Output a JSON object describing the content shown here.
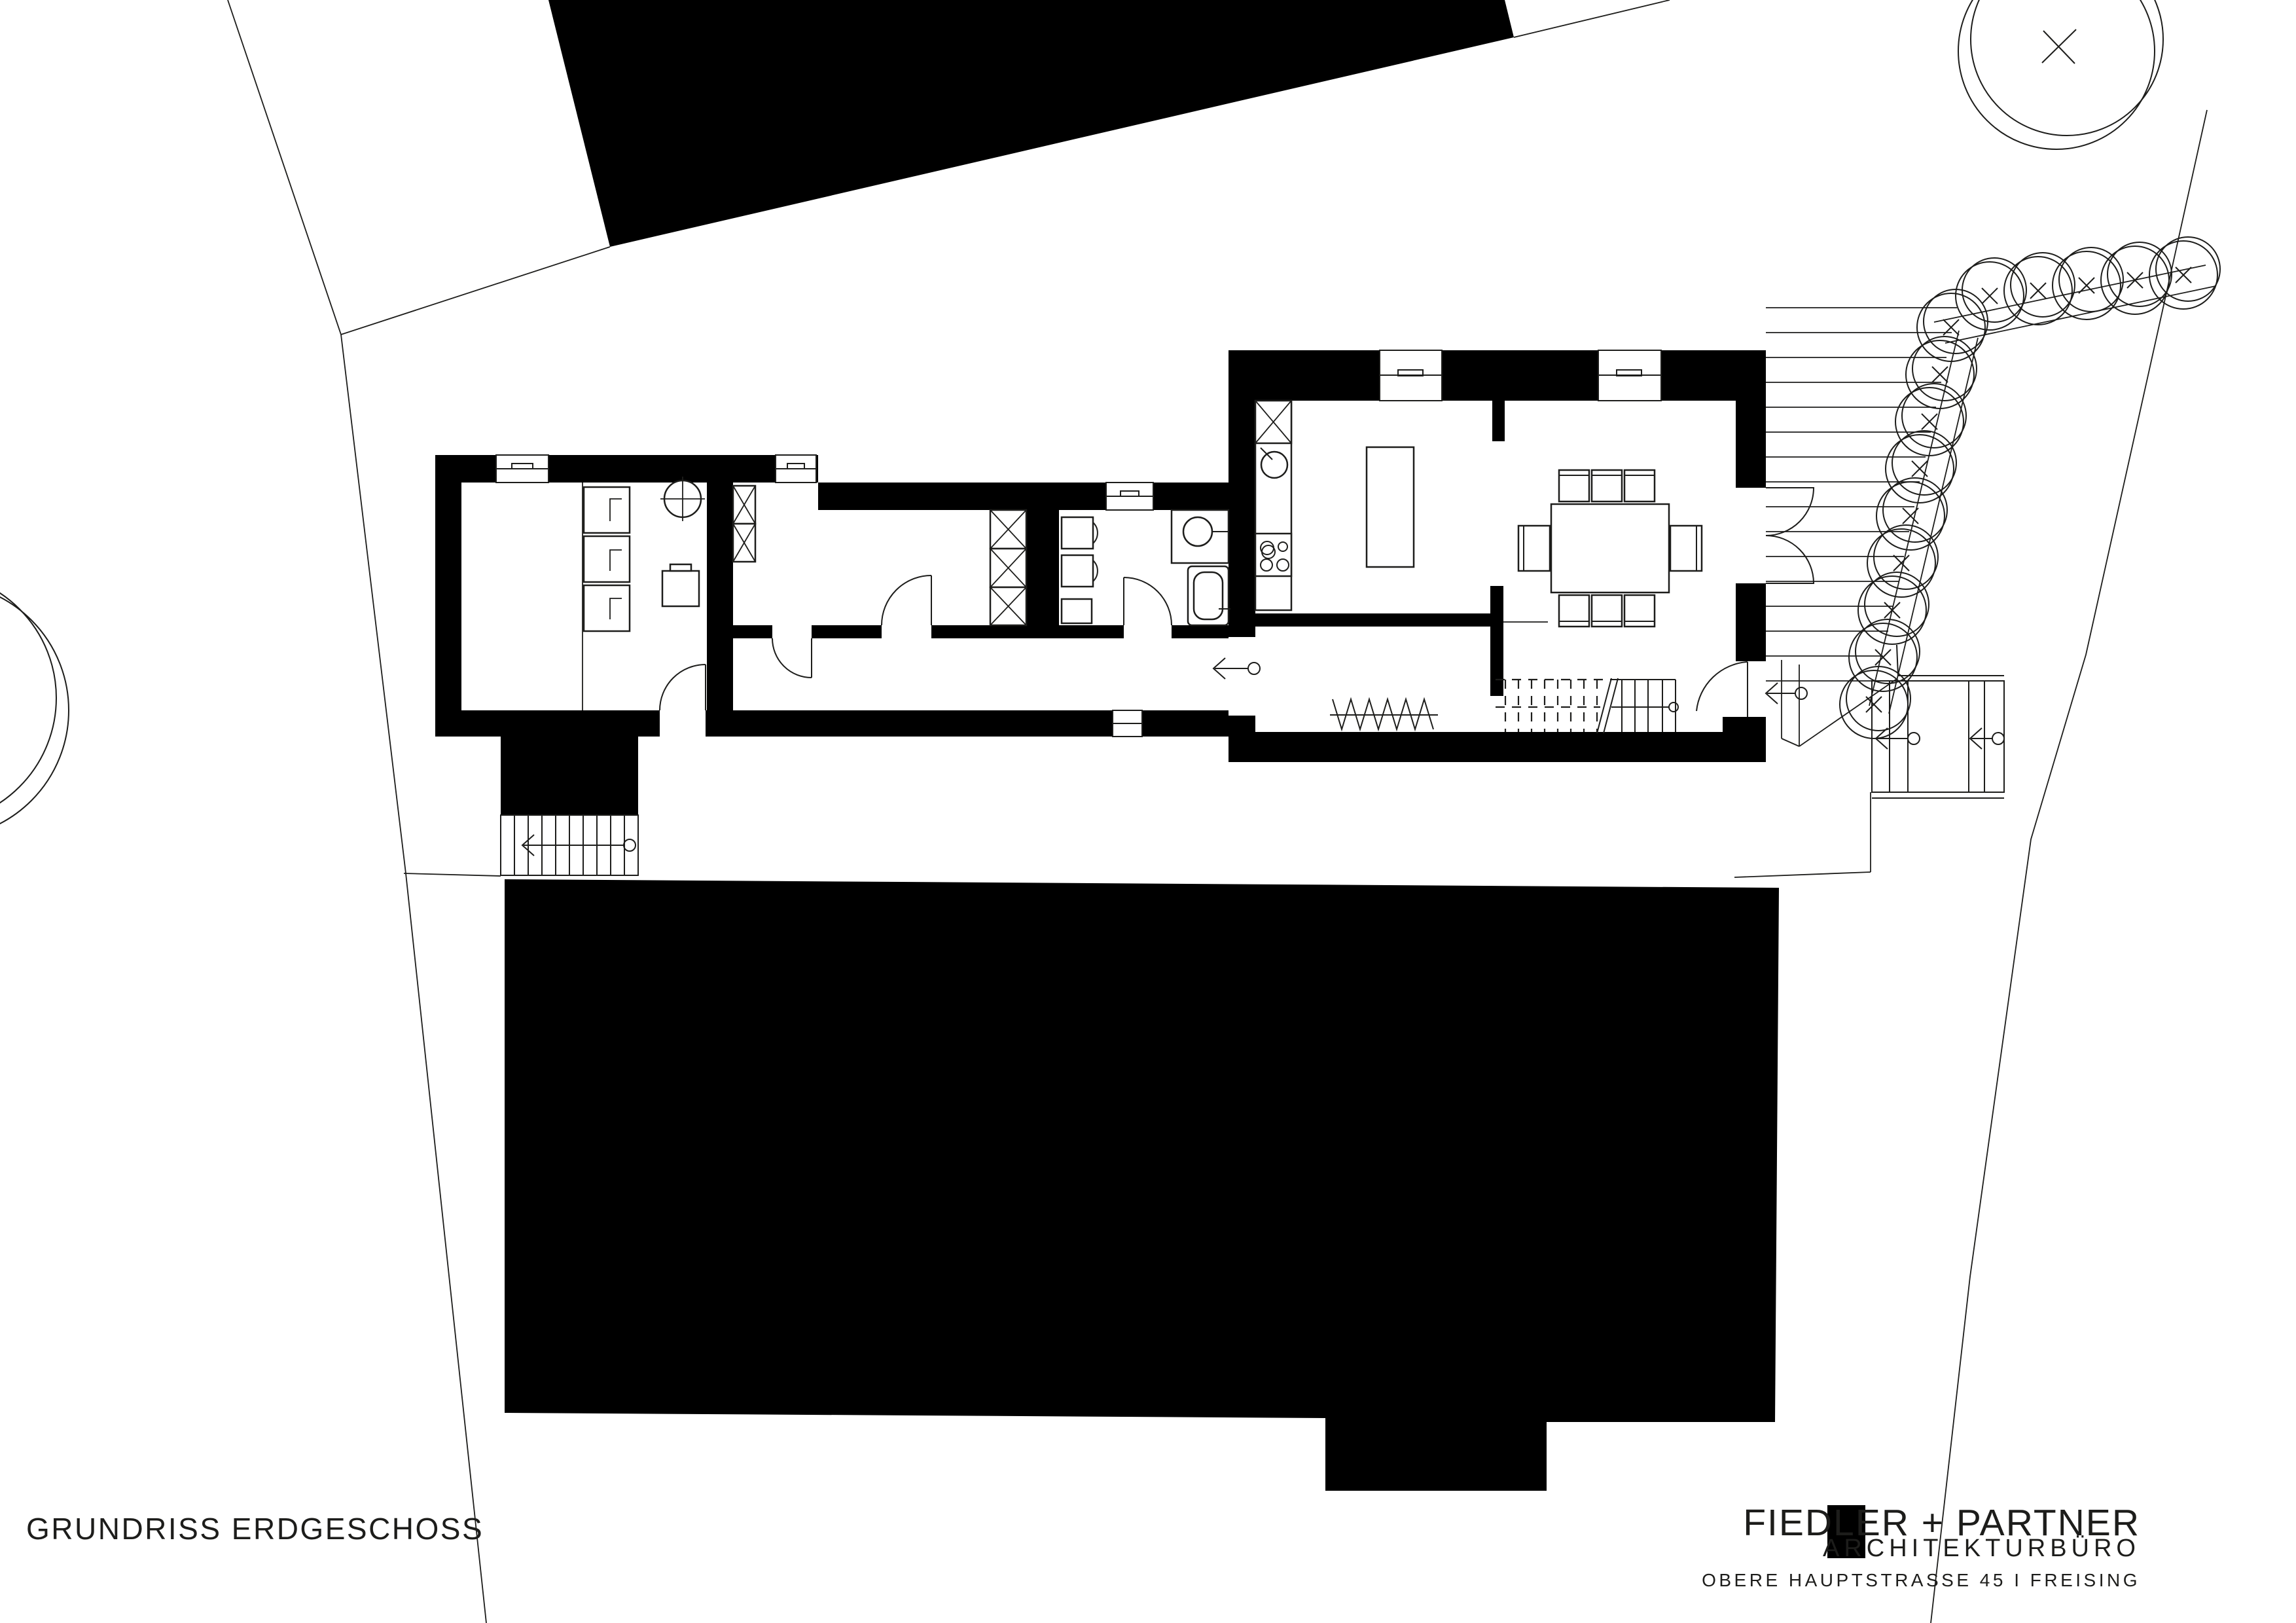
{
  "sheet": {
    "title": "GRUNDRISS ERDGESCHOSS",
    "background_color": "#ffffff",
    "ink_color": "#000000",
    "thin_line_color": "#1d1d1b"
  },
  "title_block": {
    "logo_square_color": "#000000",
    "firm_name": "FIEDLER + PARTNER",
    "firm_type": "ARCHITEKTURBÜRO",
    "address_line": "OBERE HAUPTSTRASSE 45 I FREISING"
  },
  "plan_symbols": {
    "wall": "solid black poche",
    "neighbor_building": "solid black mass",
    "tree_icon": "double offset circle with x mark",
    "entrance_arrow_icon": "left arrow with circle tail",
    "window_icon": "white wall opening with sill lines",
    "door_icon": "quarter-circle swing arc",
    "wardrobe_icon": "box with diagonal cross",
    "stair_icon": "parallel tread lines with walk-line circle",
    "deck_icon": "parallel plank lines"
  }
}
